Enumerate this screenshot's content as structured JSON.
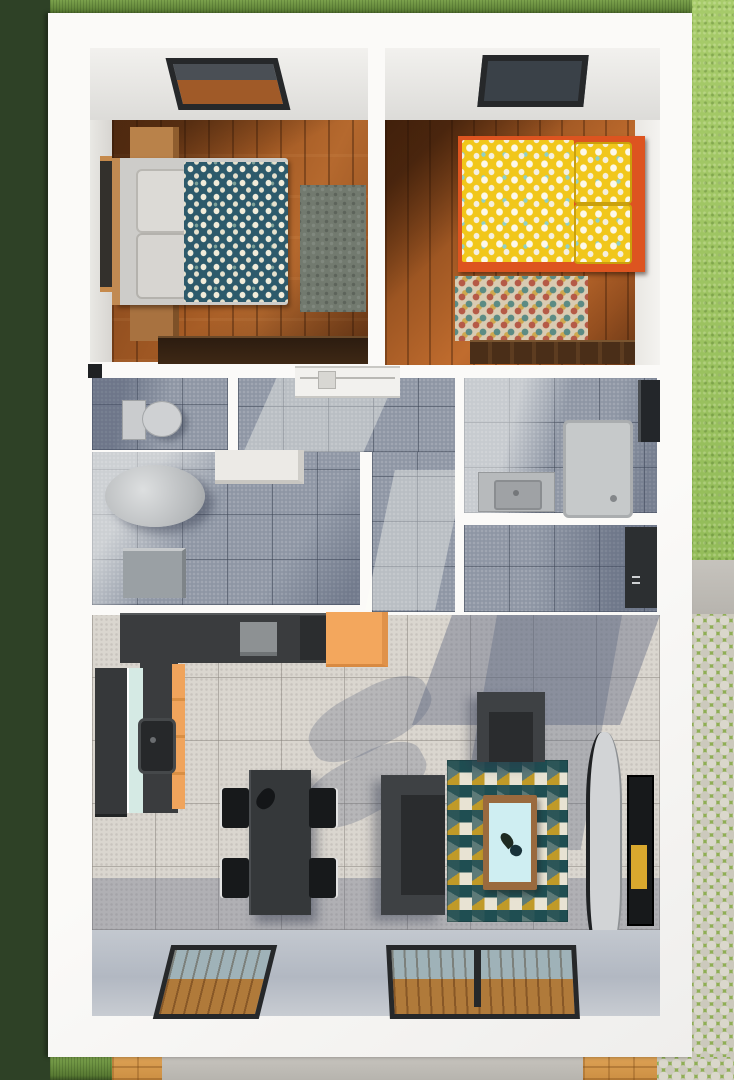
{
  "title": "3D floor plan - top-down render of a small two-bedroom house",
  "scene_type": "architectural 3d floor plan, bird's-eye view, no visible text",
  "colors": {
    "shrubs": "#2e4126",
    "grass-dark": "#6b8f3f",
    "lawn-bright": "#9cc263",
    "cobble-stone": "#d4d1c6",
    "cobble-joint": "#8fae55",
    "concrete": "#bcb9b3",
    "deck-wood": "#d89b4f",
    "wall-white": "#f8f7f4",
    "wall-shadow": "#b9bfca",
    "wood-floor": "#a35a24",
    "wood-floor-dark": "#7c431b",
    "tile-gray": "#8e96a4",
    "tile-beige": "#dad6cf",
    "duvet-navy": "#2d5a6b",
    "duvet-dot-cream": "#f1ecda",
    "bed-frame-gray": "#cdccc9",
    "pillow-gray": "#dcdad6",
    "nightstand-wood": "#b9824a",
    "rug-green-gray": "#727a6f",
    "bed2-yellow": "#f1c71b",
    "bed2-frame-orange": "#dd5420",
    "rug2-base": "#d9cbb2",
    "living-rug-teal": "#1f4e52",
    "living-rug-mustard": "#c09a28",
    "sofa-gray": "#3e4144",
    "sofa-seat": "#2a2c2e",
    "table-dark": "#35383a",
    "chair-black": "#17191b",
    "counter-dark": "#3a3c3e",
    "cabinet-orange": "#f3a75d",
    "fridge-mint": "#d5eae4",
    "fixture-white": "#cfd1d3",
    "shower-gray": "#c6c9ca",
    "door-dark": "#2c2f31",
    "tv-dark": "#17191b",
    "tv-art-yellow": "#d9a82e",
    "console-gray": "#d2d4d6",
    "window-glass": "#9fb2b8",
    "skylight-frame": "#26282a",
    "coffee-table-wood": "#9a6a3e",
    "coffee-table-glass": "#cfeef2"
  },
  "exterior": {
    "elements": [
      {
        "id": "shrubs-left",
        "label": "dense shrubs along left side"
      },
      {
        "id": "grass-strip-top",
        "label": "lawn strip above house"
      },
      {
        "id": "lawn-right",
        "label": "bright lawn right of house"
      },
      {
        "id": "cobblestone-path",
        "label": "cobblestone path bottom right"
      },
      {
        "id": "concrete-patio",
        "label": "concrete patio below house"
      },
      {
        "id": "deck-left",
        "label": "wood deck strip bottom left"
      },
      {
        "id": "deck-right",
        "label": "wood deck strip bottom right"
      }
    ]
  },
  "house": {
    "rooms": [
      {
        "id": "bedroom-1",
        "label": "bedroom with blue floral bed",
        "furniture": [
          "skylight",
          "wall-window",
          "nightstand-top",
          "nightstand-bottom",
          "double-bed-gray-frame",
          "navy-floral-duvet",
          "two-gray-pillows",
          "gray-green-rug",
          "dark-wood-dresser"
        ]
      },
      {
        "id": "bedroom-2",
        "label": "bedroom with yellow floral bed",
        "furniture": [
          "skylight",
          "orange-frame-bed",
          "yellow-floral-duvet",
          "two-yellow-pillows",
          "multicolor-rug",
          "dark-wood-dresser"
        ]
      },
      {
        "id": "wc",
        "label": "toilet room",
        "furniture": [
          "toilet",
          "small-window"
        ]
      },
      {
        "id": "hallway",
        "label": "hallway with built-in wardrobe",
        "furniture": [
          "wardrobe-top"
        ]
      },
      {
        "id": "bathroom-1",
        "label": "bathroom / laundry",
        "furniture": [
          "counter",
          "cylindrical-boiler",
          "washing-machine"
        ]
      },
      {
        "id": "bathroom-2",
        "label": "bathroom with shower",
        "furniture": [
          "vanity-sink",
          "shower-tray",
          "wall-window"
        ]
      },
      {
        "id": "entry",
        "label": "entry hall",
        "furniture": [
          "front-door"
        ]
      },
      {
        "id": "kitchen",
        "label": "L-shaped kitchen",
        "furniture": [
          "dark-counter",
          "cooktop",
          "orange-cabinet",
          "orange-drawer-front",
          "tall-unit-mint",
          "sink"
        ]
      },
      {
        "id": "dining-area",
        "label": "dining area",
        "furniture": [
          "dark-table",
          "vase",
          "chair-1",
          "chair-2",
          "chair-3",
          "chair-4"
        ]
      },
      {
        "id": "living-area",
        "label": "living area",
        "furniture": [
          "armchair",
          "sofa",
          "triangle-pattern-rug",
          "coffee-table",
          "curved-tv-console",
          "wall-tv"
        ]
      }
    ],
    "openings": [
      "floor-window-single",
      "floor-window-double",
      "bedroom1-skylight",
      "bedroom2-skylight",
      "bathroom2-window",
      "wc-window",
      "front-door"
    ]
  }
}
